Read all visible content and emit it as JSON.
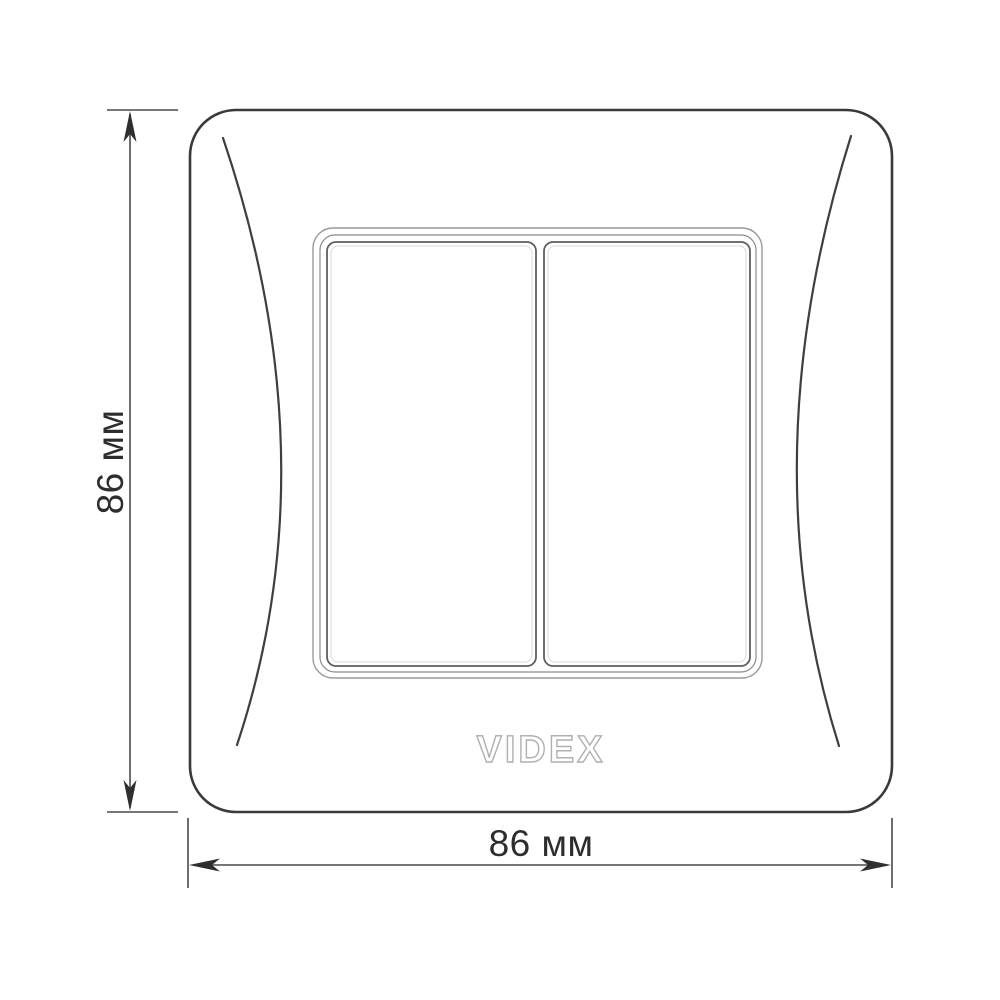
{
  "product_drawing": {
    "brand_logo": "VIDEX",
    "dimensions": {
      "height": {
        "label": "86 мм"
      },
      "width": {
        "label": "86 мм"
      }
    },
    "colors": {
      "background": "#ffffff",
      "plate_outline": "#3a3a3a",
      "curve_line": "#3f3f3f",
      "frame_outer_line": "#9a9a9a",
      "frame_middle_line": "#8b8b8b",
      "button_outline": "#5f5f5f",
      "button_highlight": "#d9d9d9",
      "dimension_line": "#4a4a4a",
      "arrow_fill": "#2f2f2f",
      "label_text": "#2d2d2d",
      "logo_outline": "#b0b0b0"
    }
  }
}
